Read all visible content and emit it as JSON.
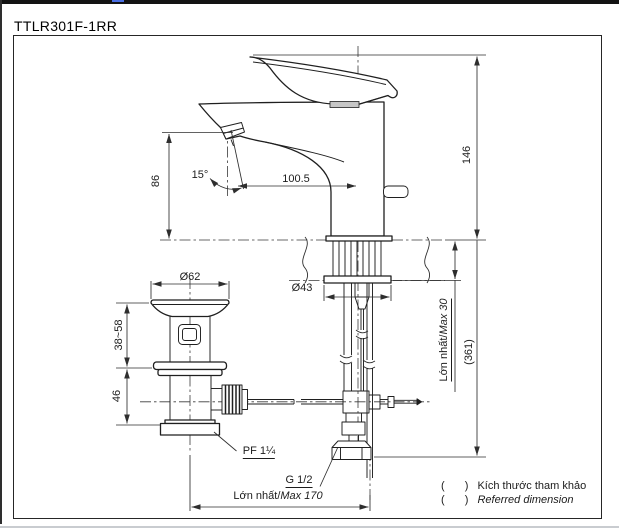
{
  "page": {
    "title": "TTLR301F-1RR"
  },
  "colors": {
    "line": "#1f1f1f",
    "joint_band_gray": "#c6c6c6",
    "top_bar_black": "#131313",
    "accent_blue_dash": "#4a6fe3",
    "page_edge_gray": "#c9ccd0"
  },
  "labels": {
    "angle": "15°",
    "spout_height": "86",
    "spout_reach": "100.5",
    "height_above_deck": "146",
    "overall_height": "(361)",
    "deck_max_vi": "Lớn nhất/",
    "deck_max_en": "Max 30",
    "drain_flange_dia": "Ø62",
    "escutcheon_dia": "Ø43",
    "drain_adjust_range": "38~58",
    "drain_lower_height": "46",
    "drain_thread": "PF 1¼",
    "supply_thread": "G 1/2",
    "span_max_vi": "Lớn nhất/",
    "span_max_en": "Max 170"
  },
  "legend": {
    "open": "(",
    "close": ")",
    "rows": [
      {
        "label": "Kích thước tham khảo",
        "lang": "vi"
      },
      {
        "label": "Referred dimension",
        "lang": "en"
      }
    ]
  }
}
